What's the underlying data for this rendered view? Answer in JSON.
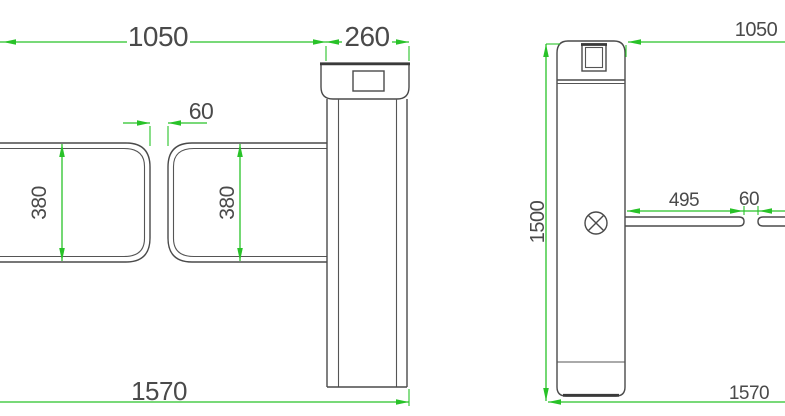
{
  "drawing": {
    "title": "Swing barrier turnstile dimension drawing",
    "colors": {
      "dimension_green": "#28c228",
      "outline_gray": "#4a4a4a",
      "background": "#ffffff"
    },
    "front_view": {
      "dimensions": {
        "passage_width": "1050",
        "cabinet_width": "260",
        "arm_gap": "60",
        "left_arm_height": "380",
        "right_arm_height": "380",
        "overall_width": "1570"
      }
    },
    "side_view": {
      "dimensions": {
        "lane_width": "1050",
        "cabinet_height": "1500",
        "arm_length": "495",
        "arm_gap": "60",
        "overall_width": "1570"
      }
    }
  }
}
